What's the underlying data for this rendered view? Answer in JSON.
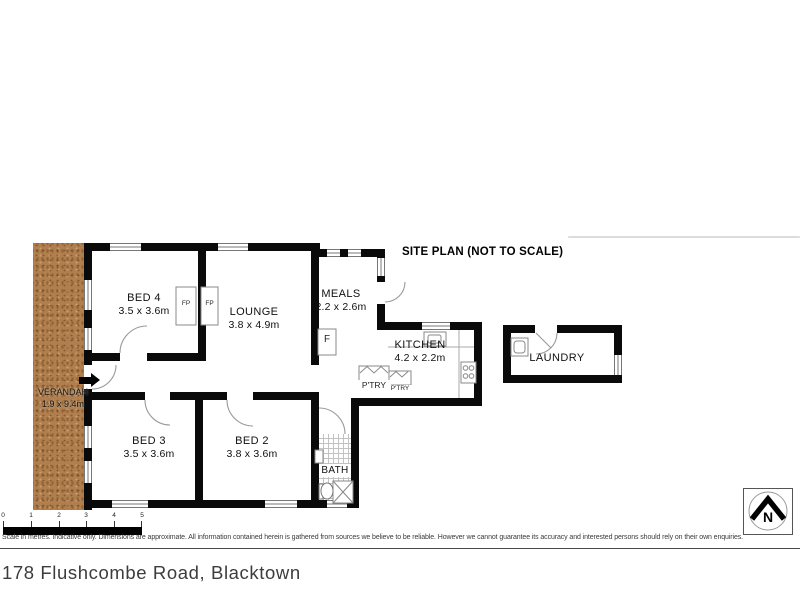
{
  "site_plan": {
    "title": "SITE PLAN (NOT TO SCALE)"
  },
  "rooms": {
    "bed4": {
      "name": "BED 4",
      "dims": "3.5 x 3.6m"
    },
    "lounge": {
      "name": "LOUNGE",
      "dims": "3.8 x 4.9m"
    },
    "meals": {
      "name": "MEALS",
      "dims": "2.2 x 2.6m"
    },
    "kitchen": {
      "name": "KITCHEN",
      "dims": "4.2 x 2.2m"
    },
    "laundry": {
      "name": "LAUNDRY"
    },
    "bed3": {
      "name": "BED 3",
      "dims": "3.5 x 3.6m"
    },
    "bed2": {
      "name": "BED 2",
      "dims": "3.8 x 3.6m"
    },
    "bath": {
      "name": "BATH"
    },
    "verandah": {
      "name": "VERANDAH",
      "dims": "1.9 x 9.4m"
    }
  },
  "fixtures": {
    "fireplace_left": "FP",
    "fireplace_right": "FP",
    "fridge": "F",
    "pantry": "P'TRY",
    "pantry_small": "P'TRY"
  },
  "compass": {
    "label": "N"
  },
  "scale_bar": {
    "ticks": [
      "0",
      "1",
      "2",
      "3",
      "4",
      "5"
    ]
  },
  "footer": {
    "disclaimer": "Scale in metres. Indicative only. Dimensions are approximate. All information contained herein is gathered from sources we believe to be reliable. However we cannot guarantee its accuracy and interested persons should rely on their own enquiries.",
    "address": "178 Flushcombe Road, Blacktown"
  },
  "colors": {
    "wall": "#0a0a0a",
    "verandah": "#b17f4e"
  }
}
